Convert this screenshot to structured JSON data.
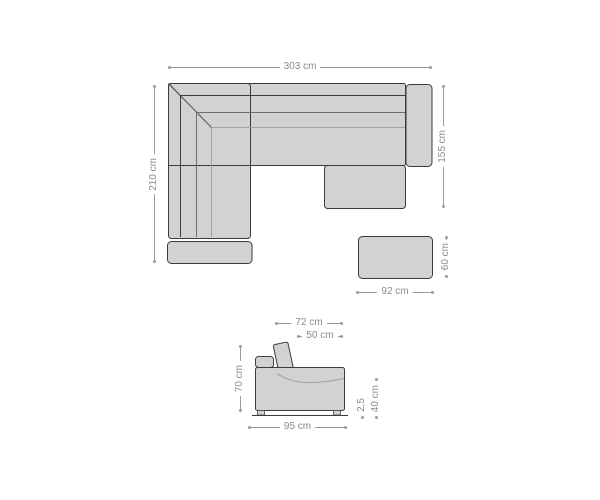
{
  "diagram": {
    "type": "sofa-dimension-diagram",
    "views": {
      "top_view_name": "top view",
      "side_view_name": "side view"
    }
  },
  "colors": {
    "background": "#ffffff",
    "sofa_fill": "#d2d2d2",
    "outline": "#3c3c3c",
    "seam": "#6f6f6f",
    "seam_light": "#a2a2a2",
    "dimension_line": "#9b9b9b",
    "dimension_text": "#8a8a8a"
  },
  "top_view": {
    "dimensions": {
      "total_width": "303 cm",
      "left_depth": "210 cm",
      "right_depth": "155 cm",
      "stool_width": "92 cm",
      "stool_depth": "60 cm"
    }
  },
  "side_view": {
    "dimensions": {
      "total_depth": "72 cm",
      "seat_depth": "50 cm",
      "total_height": "70 cm",
      "base_width": "95 cm",
      "seat_height": "40 cm",
      "ground_clearance": "2,5"
    }
  }
}
